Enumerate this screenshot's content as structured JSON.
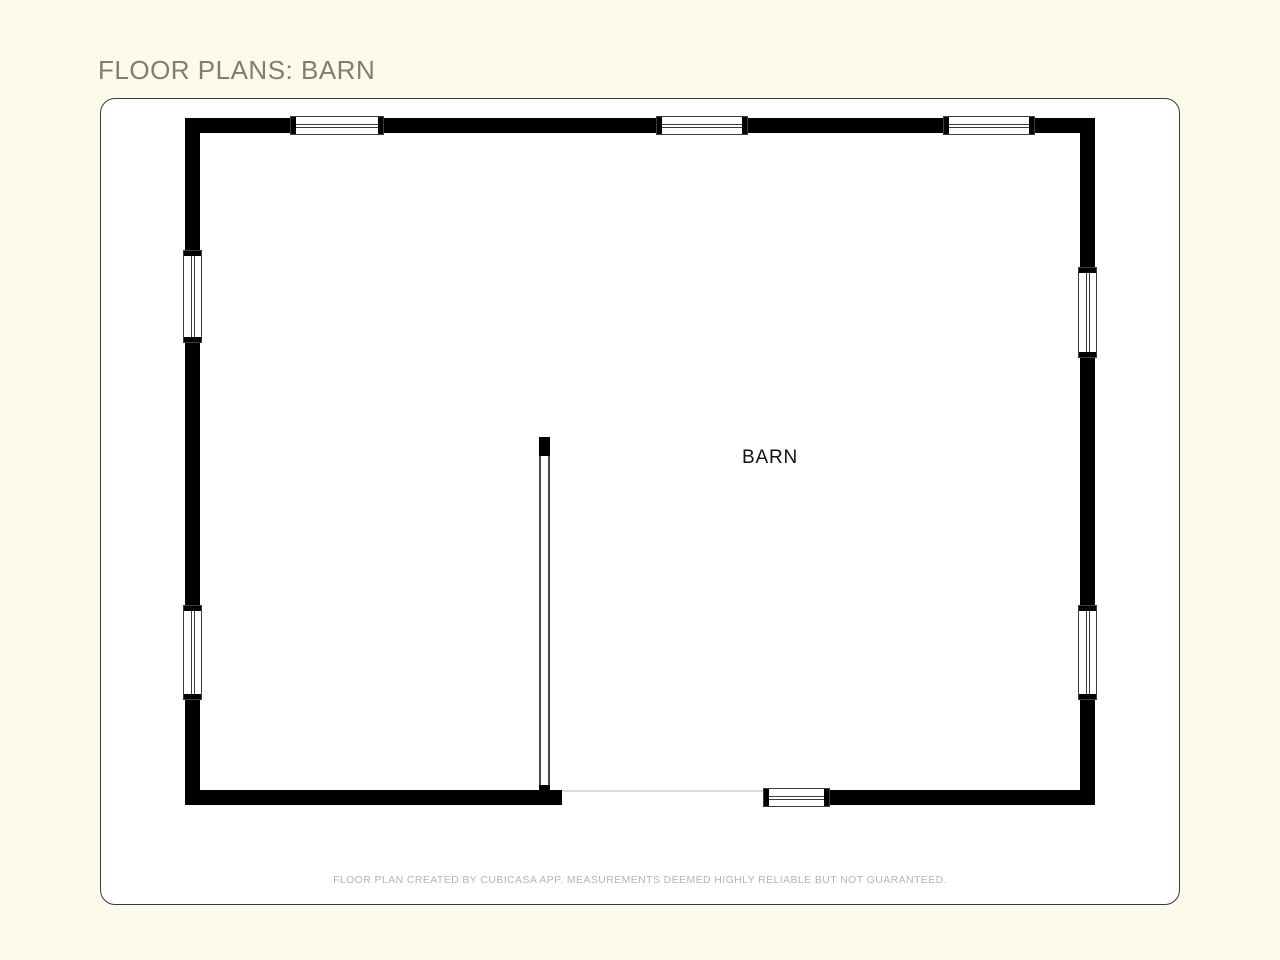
{
  "header": {
    "title": "FLOOR PLANS: BARN"
  },
  "floor_plan": {
    "room_label": "BARN",
    "walls": [
      {
        "name": "top",
        "x": 185,
        "y": 118,
        "w": 910,
        "h": 15
      },
      {
        "name": "left",
        "x": 185,
        "y": 118,
        "w": 15,
        "h": 687
      },
      {
        "name": "right",
        "x": 1080,
        "y": 118,
        "w": 15,
        "h": 687
      },
      {
        "name": "bottom-left",
        "x": 185,
        "y": 790,
        "w": 377,
        "h": 15
      },
      {
        "name": "bottom-right",
        "x": 830,
        "y": 790,
        "w": 265,
        "h": 15
      }
    ],
    "interior_wall": {
      "x": 539,
      "y": 437,
      "w": 11,
      "h": 353,
      "cap_top": 19,
      "cap_bottom": 5
    },
    "opening": {
      "x": 562,
      "y": 790,
      "w": 201,
      "h": 2
    },
    "windows": [
      {
        "orient": "h",
        "x": 290,
        "y": 116,
        "len": 94
      },
      {
        "orient": "h",
        "x": 656,
        "y": 116,
        "len": 92
      },
      {
        "orient": "h",
        "x": 943,
        "y": 116,
        "len": 92
      },
      {
        "orient": "v",
        "x": 183,
        "y": 250,
        "len": 93
      },
      {
        "orient": "v",
        "x": 183,
        "y": 605,
        "len": 95
      },
      {
        "orient": "v",
        "x": 1078,
        "y": 267,
        "len": 91
      },
      {
        "orient": "v",
        "x": 1078,
        "y": 605,
        "len": 95
      },
      {
        "orient": "h",
        "x": 763,
        "y": 788,
        "len": 67
      }
    ]
  },
  "footer": {
    "disclaimer": "FLOOR PLAN CREATED BY CUBICASA APP. MEASUREMENTS DEEMED HIGHLY RELIABLE BUT NOT GUARANTEED."
  },
  "colors": {
    "page_background": "#fcfaea",
    "card_background": "#ffffff",
    "card_border": "#3a3a3a",
    "title_text": "#847c6d",
    "wall": "#000000",
    "window_border": "#3d3d3d",
    "room_label_text": "#111111",
    "disclaimer_text": "#b5b5b5",
    "opening_threshold": "#dcdcdc"
  }
}
